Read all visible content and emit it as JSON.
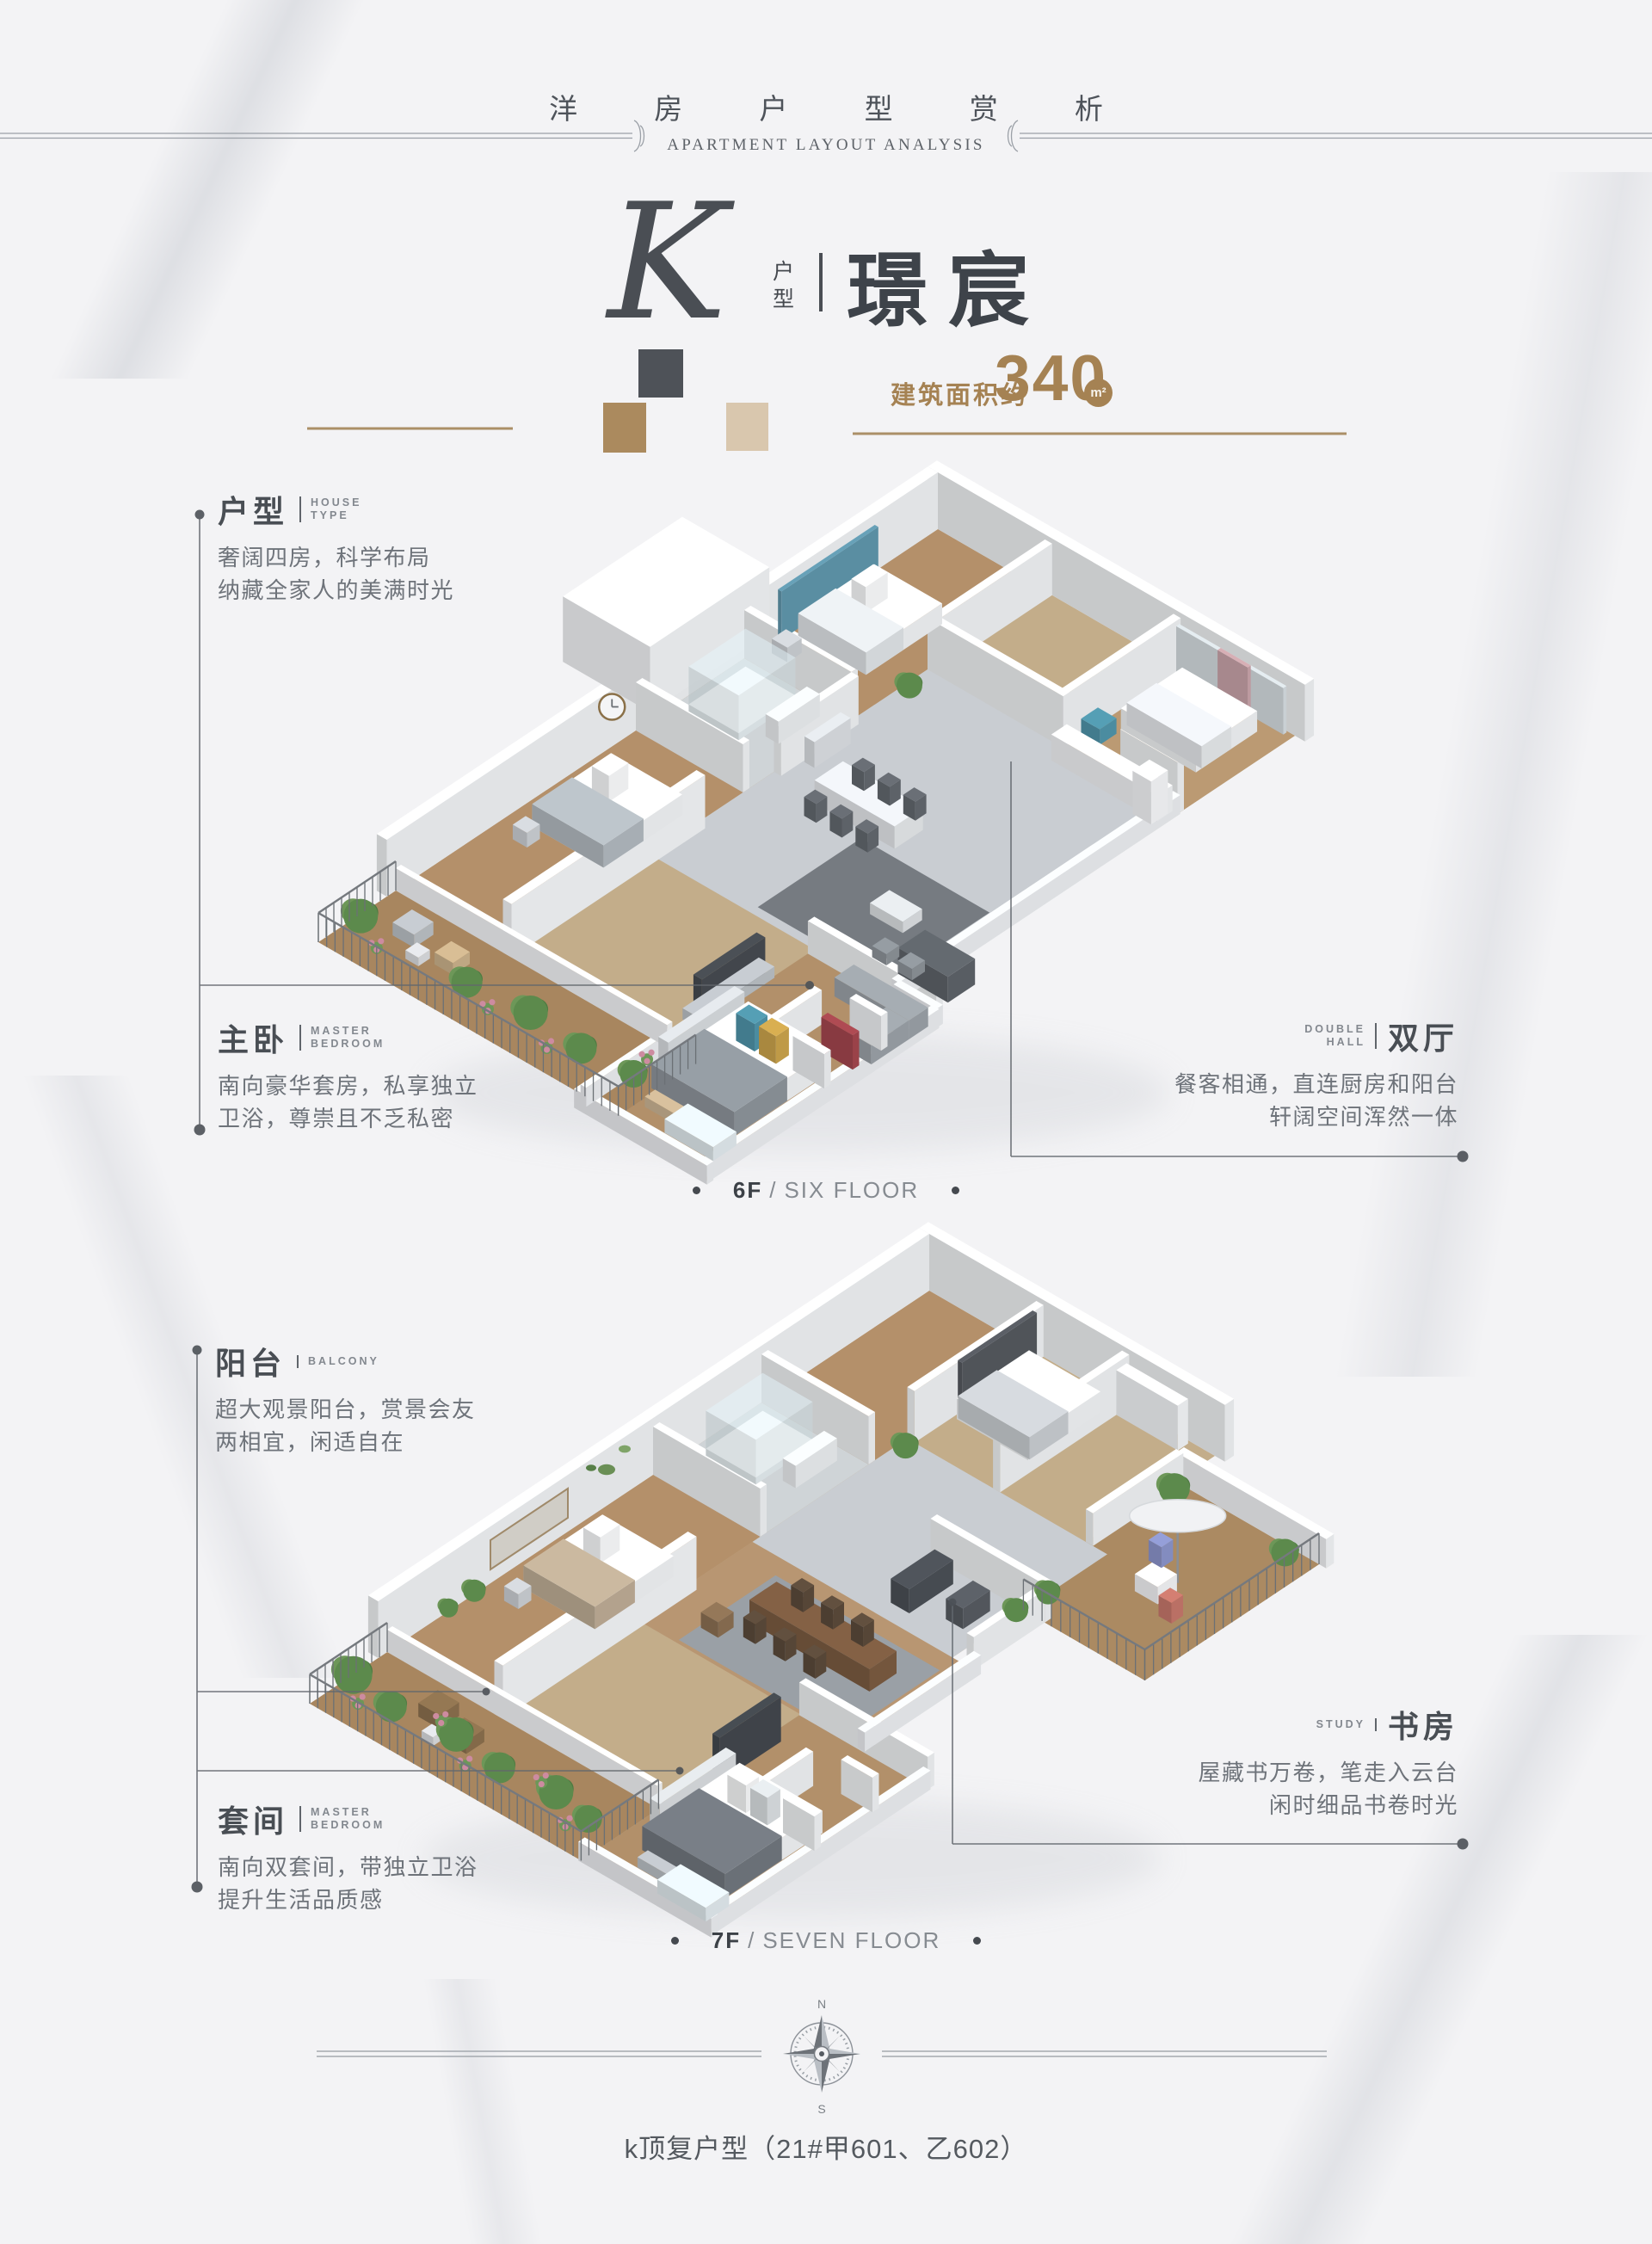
{
  "header": {
    "title_cn": "洋 房 户 型 赏 析",
    "title_en": "APARTMENT LAYOUT ANALYSIS"
  },
  "hero": {
    "letter": "K",
    "letter_tag": "户型",
    "name": "璟宸",
    "area_label": "建筑面积约",
    "area_value": "340",
    "area_unit": "m²"
  },
  "colors": {
    "accent_gold": "#a58253",
    "swatch_dark": "#4e5258",
    "swatch_tan": "#ab8a5e",
    "swatch_beige": "#d9c7ae"
  },
  "callouts": [
    {
      "title": "户型",
      "en1": "HOUSE",
      "en2": "TYPE",
      "lines": [
        "奢阔四房，科学布局",
        "纳藏全家人的美满时光"
      ]
    },
    {
      "title": "主卧",
      "en1": "MASTER",
      "en2": "BEDROOM",
      "lines": [
        "南向豪华套房，私享独立",
        "卫浴，尊崇且不乏私密"
      ]
    },
    {
      "title": "双厅",
      "en1": "DOUBLE",
      "en2": "HALL",
      "lines": [
        "餐客相通，直连厨房和阳台",
        "轩阔空间浑然一体"
      ]
    },
    {
      "title": "阳台",
      "en1": "BALCONY",
      "en2": "",
      "lines": [
        "超大观景阳台，赏景会友",
        "两相宜，闲适自在"
      ]
    },
    {
      "title": "套间",
      "en1": "MASTER",
      "en2": "BEDROOM",
      "lines": [
        "南向双套间，带独立卫浴",
        "提升生活品质感"
      ]
    },
    {
      "title": "书房",
      "en1": "STUDY",
      "en2": "",
      "lines": [
        "屋藏书万卷，笔走入云台",
        "闲时细品书卷时光"
      ]
    }
  ],
  "floors": [
    {
      "tag": "6F",
      "name": "SIX FLOOR"
    },
    {
      "tag": "7F",
      "name": "SEVEN FLOOR"
    }
  ],
  "compass": {
    "north": "N",
    "south": "S"
  },
  "footer": {
    "text": "k顶复户型（21#甲601、乙602）"
  }
}
